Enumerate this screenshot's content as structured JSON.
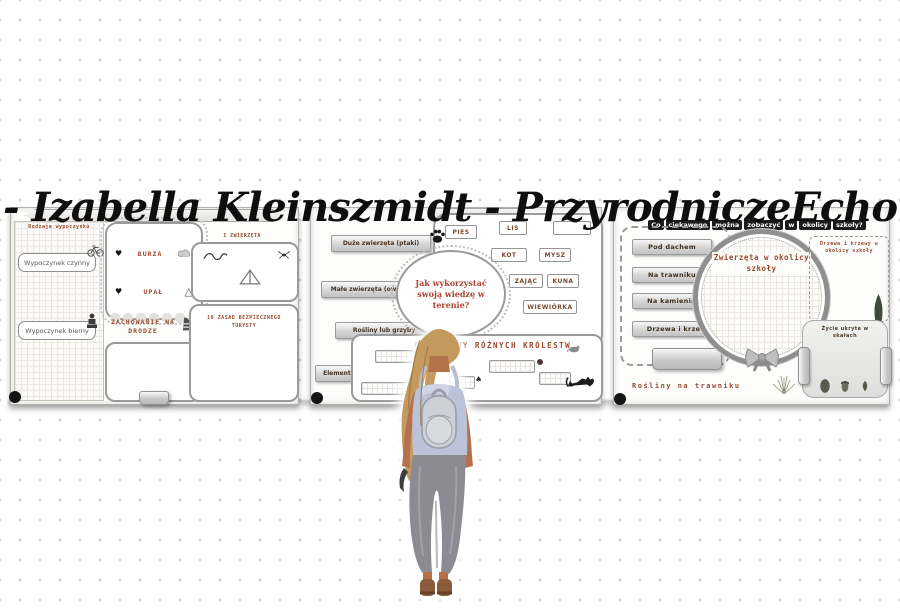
{
  "title": {
    "text": "- Izabella Kleinszmidt - PrzyrodniczeEcho"
  },
  "icons": {
    "heart": "♥",
    "warning_triangle": "△",
    "spade": "♠"
  },
  "panel_rest": {
    "column_header": "Rodzaje wypoczynku",
    "active_rest": "Wypoczynek czynny",
    "passive_rest": "Wypoczynek bierny",
    "storm": "BURZA",
    "heat": "UPAŁ",
    "road_heading": "ZACHOWANIE NA DRODZE",
    "animals_caption": "I ZWIERZĘTA",
    "rules_heading": "10 ZASAD BEZPIECZNEGO TURYSTY"
  },
  "panel_knowledge": {
    "tags": [
      "Duże zwierzęta (ptaki)",
      "Małe zwierzęta (owady)",
      "Rośliny lub grzyby",
      "Elementy przyrody nieożywionej"
    ],
    "question": "Jak wykorzystać swoją wiedzę w terenie?",
    "animals": [
      "PIES",
      "LIS",
      "",
      "KOT",
      "MYSZ",
      "ZAJĄC",
      "KUNA",
      "WIEWIÓRKA"
    ],
    "kingdoms_heading": "ORGANIZMY RÓŻNYCH KRÓLESTW"
  },
  "panel_school": {
    "banner_words": [
      "Co",
      "ciekawego",
      "można",
      "zobaczyć",
      "w",
      "okolicy",
      "szkoły?"
    ],
    "buttons": [
      "Pod dachem",
      "Na trawniku",
      "Na kamieniach",
      "Drzewa i krzewy"
    ],
    "circle_heading": "Zwierzęta w okolicy szkoły",
    "trees_heading": "Drzewa i krzewy w okolicy szkoły",
    "rocks_heading": "Życie ukryte w skałach",
    "bottom_caption": "Rośliny na trawniku"
  }
}
